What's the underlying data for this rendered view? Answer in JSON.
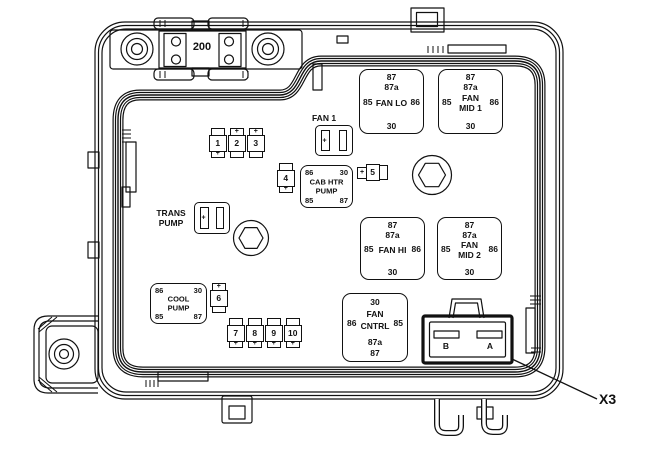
{
  "colors": {
    "line": "#111111",
    "bg": "#ffffff"
  },
  "mega_fuse": {
    "label": "200"
  },
  "labels": {
    "fan1": "FAN 1",
    "trans1": "TRANS",
    "trans2": "PUMP"
  },
  "holder_plus": "+",
  "relays": {
    "fan_lo": {
      "p_top1": "87",
      "p_top2": "87a",
      "p_left": "85",
      "p_right": "86",
      "p_bottom": "30",
      "name1": "FAN LO",
      "name2": ""
    },
    "fan_mid1": {
      "p_top1": "87",
      "p_top2": "87a",
      "p_left": "85",
      "p_right": "86",
      "p_bottom": "30",
      "name1": "FAN",
      "name2": "MID 1"
    },
    "fan_hi": {
      "p_top1": "87",
      "p_top2": "87a",
      "p_left": "85",
      "p_right": "86",
      "p_bottom": "30",
      "name1": "FAN HI",
      "name2": ""
    },
    "fan_mid2": {
      "p_top1": "87",
      "p_top2": "87a",
      "p_left": "85",
      "p_right": "86",
      "p_bottom": "30",
      "name1": "FAN",
      "name2": "MID 2"
    },
    "cab_htr": {
      "tl": "86",
      "tr": "30",
      "bl": "85",
      "br": "87",
      "name1": "CAB HTR",
      "name2": "PUMP"
    },
    "cool_pump": {
      "tl": "86",
      "tr": "30",
      "bl": "85",
      "br": "87",
      "name1": "COOL",
      "name2": "PUMP"
    },
    "fan_cntrl": {
      "top": "30",
      "left": "86",
      "right": "85",
      "name1": "FAN",
      "name2": "CNTRL",
      "b1": "87a",
      "b2": "87"
    }
  },
  "fuses": {
    "f1": {
      "top": "",
      "num": "1",
      "bottom": "+"
    },
    "f2": {
      "top": "+",
      "num": "2",
      "bottom": ""
    },
    "f3": {
      "top": "+",
      "num": "3",
      "bottom": ""
    },
    "f4": {
      "top": "",
      "num": "4",
      "bottom": "+"
    },
    "f5": {
      "left": "+",
      "num": "5",
      "right": ""
    },
    "f6": {
      "top": "+",
      "num": "6",
      "bottom": ""
    },
    "f7": {
      "top": "",
      "num": "7",
      "bottom": "+"
    },
    "f8": {
      "top": "",
      "num": "8",
      "bottom": "+"
    },
    "f9": {
      "top": "",
      "num": "9",
      "bottom": "+"
    },
    "f10": {
      "top": "",
      "num": "10",
      "bottom": "+"
    }
  },
  "connector": {
    "b": "B",
    "a": "A",
    "callout": "X3"
  }
}
